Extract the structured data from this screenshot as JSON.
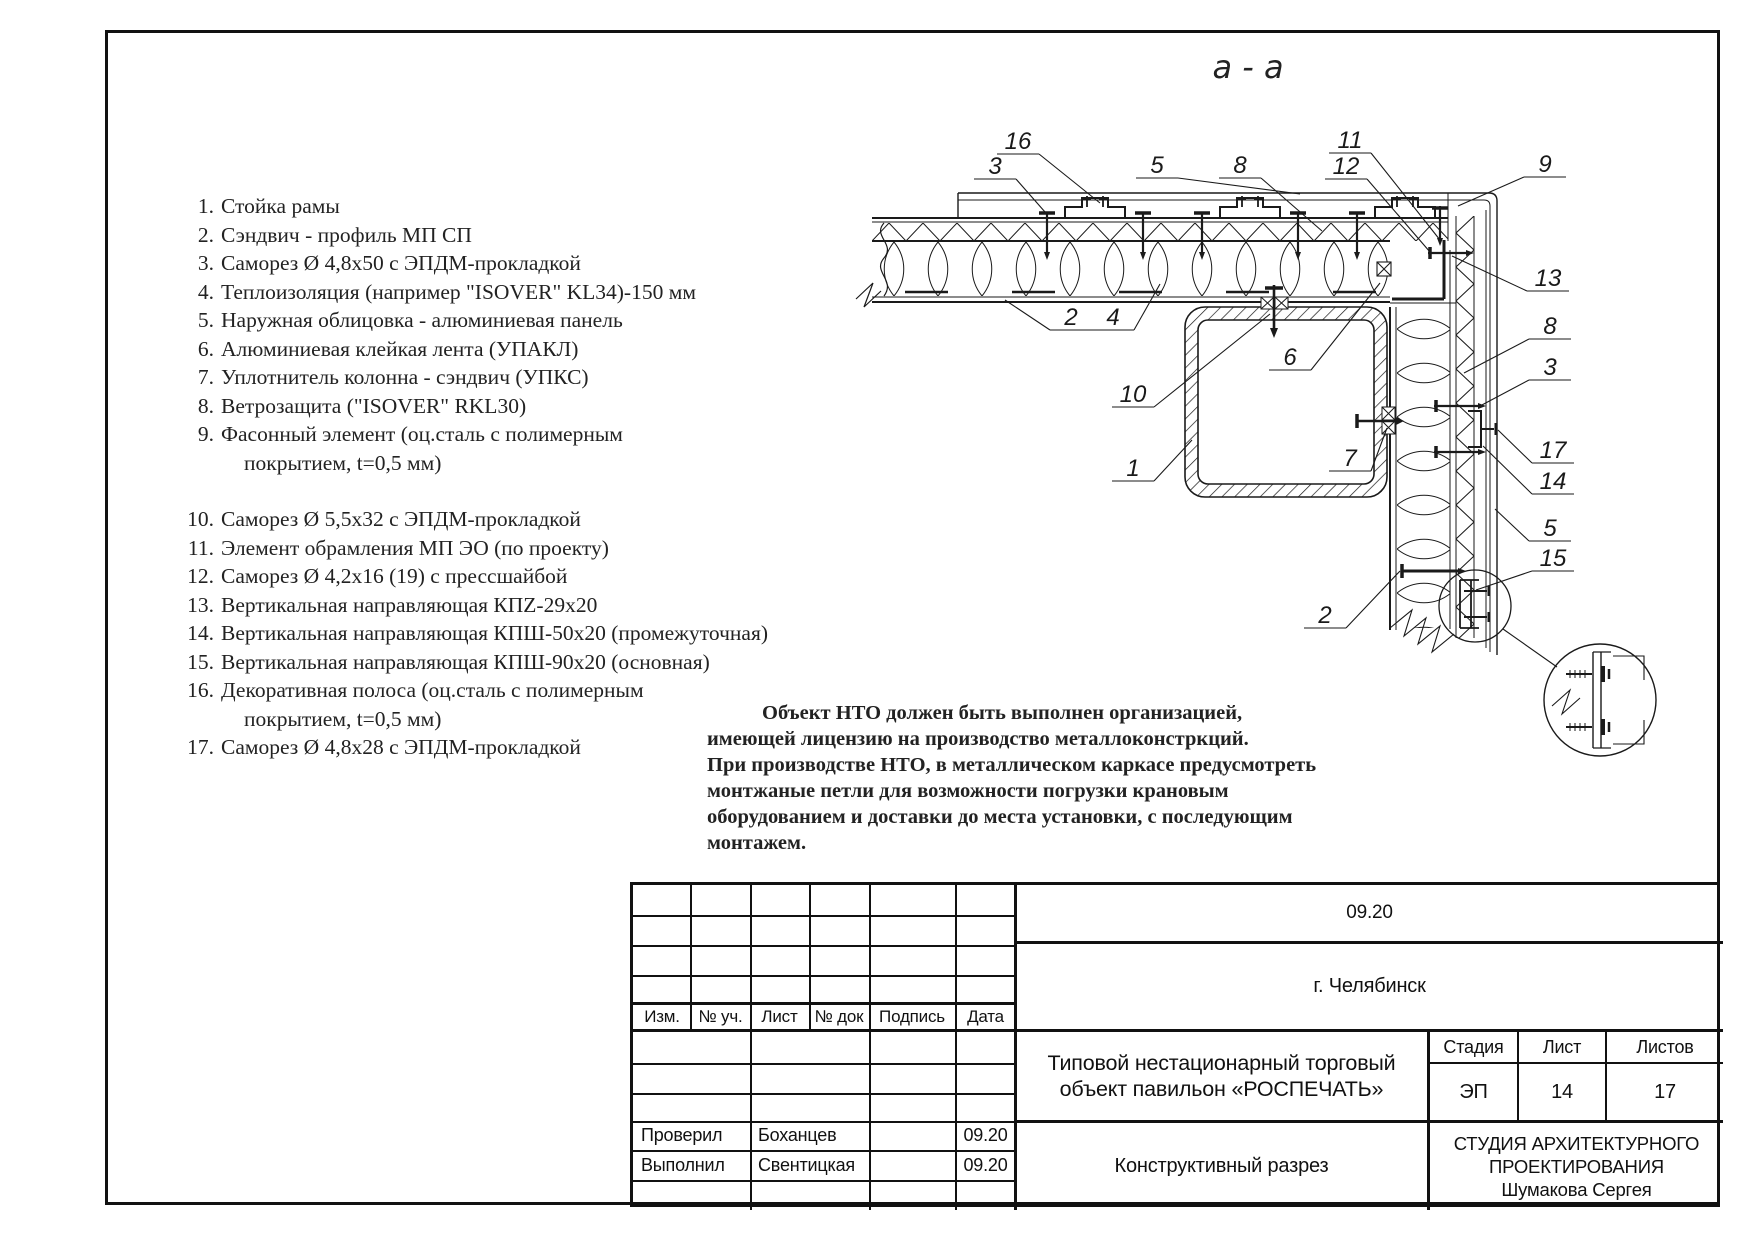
{
  "page": {
    "bg": "#ffffff",
    "frame_color": "#111111"
  },
  "drawing": {
    "section_title": "а - а",
    "line_color": "#1a1a1a",
    "callouts": [
      {
        "label": "16",
        "x": 1018,
        "y": 141,
        "side": "r",
        "ex": 1100,
        "ey": 203
      },
      {
        "label": "3",
        "x": 995,
        "y": 166,
        "side": "r",
        "ex": 1045,
        "ey": 212
      },
      {
        "label": "5",
        "x": 1157,
        "y": 165,
        "side": "r",
        "ex": 1300,
        "ey": 194
      },
      {
        "label": "8",
        "x": 1240,
        "y": 165,
        "side": "r",
        "ex": 1322,
        "ey": 231
      },
      {
        "label": "11",
        "x": 1350,
        "y": 140,
        "side": "r",
        "ex": 1440,
        "ey": 240
      },
      {
        "label": "12",
        "x": 1346,
        "y": 166,
        "side": "r",
        "ex": 1430,
        "ey": 252
      },
      {
        "label": "9",
        "x": 1545,
        "y": 164,
        "side": "l",
        "ex": 1458,
        "ey": 206
      },
      {
        "label": "13",
        "x": 1548,
        "y": 278,
        "side": "l",
        "ex": 1452,
        "ey": 256
      },
      {
        "label": "8",
        "x": 1550,
        "y": 326,
        "side": "l",
        "ex": 1464,
        "ey": 373
      },
      {
        "label": "3",
        "x": 1550,
        "y": 367,
        "side": "l",
        "ex": 1480,
        "ey": 406
      },
      {
        "label": "17",
        "x": 1553,
        "y": 450,
        "side": "l",
        "ex": 1498,
        "ey": 430
      },
      {
        "label": "14",
        "x": 1553,
        "y": 481,
        "side": "l",
        "ex": 1483,
        "ey": 446
      },
      {
        "label": "5",
        "x": 1550,
        "y": 528,
        "side": "l",
        "ex": 1495,
        "ey": 509
      },
      {
        "label": "15",
        "x": 1553,
        "y": 558,
        "side": "l",
        "ex": 1476,
        "ey": 590
      },
      {
        "label": "2",
        "x": 1071,
        "y": 317,
        "side": "l",
        "ex": 1005,
        "ey": 300
      },
      {
        "label": "4",
        "x": 1113,
        "y": 317,
        "side": "r",
        "ex": 1160,
        "ey": 284
      },
      {
        "label": "10",
        "x": 1133,
        "y": 394,
        "side": "r",
        "ex": 1270,
        "ey": 314
      },
      {
        "label": "1",
        "x": 1133,
        "y": 468,
        "side": "r",
        "ex": 1192,
        "ey": 440
      },
      {
        "label": "6",
        "x": 1290,
        "y": 357,
        "side": "r",
        "ex": 1380,
        "ey": 283
      },
      {
        "label": "7",
        "x": 1350,
        "y": 458,
        "side": "r",
        "ex": 1387,
        "ey": 428
      },
      {
        "label": "2",
        "x": 1325,
        "y": 615,
        "side": "r",
        "ex": 1400,
        "ey": 571
      }
    ]
  },
  "legend": {
    "items": [
      {
        "num": "1.",
        "text": "Стойка рамы"
      },
      {
        "num": "2.",
        "text": "Сэндвич - профиль МП СП"
      },
      {
        "num": "3.",
        "text": "Саморез Ø 4,8х50 с ЭПДМ-прокладкой"
      },
      {
        "num": "4.",
        "text": "Теплоизоляция (например \"ISOVER\" KL34)-150 мм"
      },
      {
        "num": "5.",
        "text": "Наружная облицовка - алюминиевая панель"
      },
      {
        "num": "6.",
        "text": "Алюминиевая клейкая лента (УПАКЛ)"
      },
      {
        "num": "7.",
        "text": "Уплотнитель колонна - сэндвич (УПКС)"
      },
      {
        "num": "8.",
        "text": "Ветрозащита (\"ISOVER\" RKL30)"
      },
      {
        "num": "9.",
        "text": "Фасонный элемент (оц.сталь с полимерным",
        "cont": "покрытием, t=0,5 мм)"
      },
      {
        "num": "10.",
        "text": "Саморез Ø 5,5х32 с ЭПДМ-прокладкой",
        "gap": true
      },
      {
        "num": "11.",
        "text": "Элемент обрамления МП ЭО (по проекту)"
      },
      {
        "num": "12.",
        "text": "Саморез Ø 4,2х16 (19) с прессшайбой"
      },
      {
        "num": "13.",
        "text": "Вертикальная направляющая КПZ-29х20"
      },
      {
        "num": "14.",
        "text": "Вертикальная направляющая КПШ-50х20 (промежуточная)"
      },
      {
        "num": "15.",
        "text": "Вертикальная направляющая КПШ-90х20 (основная)"
      },
      {
        "num": "16.",
        "text": "Декоративная полоса (оц.сталь с полимерным",
        "cont": "покрытием, t=0,5 мм)"
      },
      {
        "num": "17.",
        "text": "Саморез Ø 4,8х28 с ЭПДМ-прокладкой"
      }
    ]
  },
  "notes": {
    "lines": [
      "Объект НТО  должен быть выполнен организацией,",
      "имеющей лицензию на производство металлоконстркций.",
      "При производстве НТО, в металлическом каркасе предусмотреть",
      "монтжаные петли для возможности погрузки крановым",
      "оборудованием и доставки до места установки, с последующим",
      "монтажем."
    ]
  },
  "title_block": {
    "doc_date": "09.20",
    "city": "г. Челябинск",
    "project_line1": "Типовой нестационарный торговый",
    "project_line2": "объект  павильон «РОСПЕЧАТЬ»",
    "stage_label": "Стадия",
    "sheet_label": "Лист",
    "sheets_label": "Листов",
    "stage": "ЭП",
    "sheet": "14",
    "sheets": "17",
    "drawing_name": "Конструктивный разрез",
    "org_line1": "СТУДИЯ АРХИТЕКТУРНОГО",
    "org_line2": "ПРОЕКТИРОВАНИЯ",
    "org_line3": "Шумакова Сергея",
    "cols": [
      "Изм.",
      "№ уч.",
      "Лист",
      "№ док",
      "Подпись",
      "Дата"
    ],
    "sign_rows": [
      {
        "role": "Проверил",
        "name": "Боханцев",
        "sign": "",
        "date": "09.20"
      },
      {
        "role": "Выполнил",
        "name": "Свентицкая",
        "sign": "",
        "date": "09.20"
      }
    ]
  }
}
